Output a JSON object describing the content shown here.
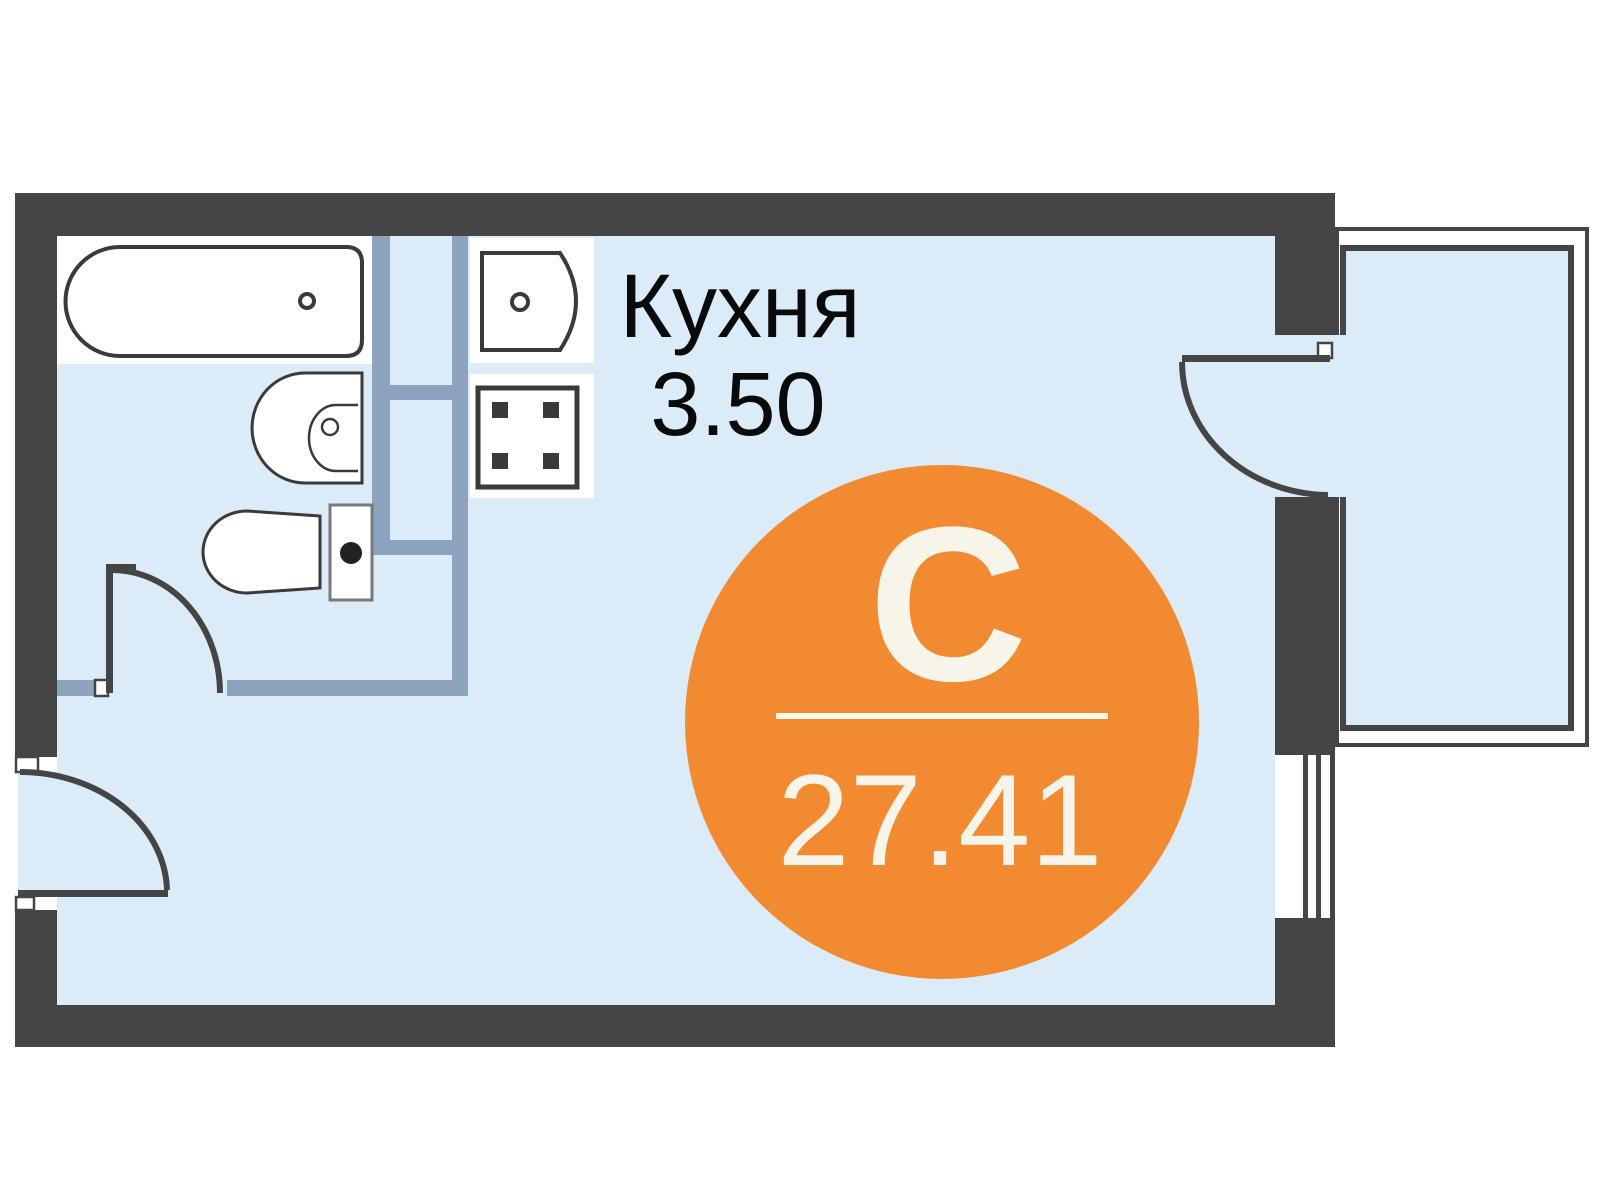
{
  "rooms": {
    "kitchen": {
      "label": "Кухня",
      "area": "3.50"
    }
  },
  "unit_badge": {
    "letter": "С",
    "area": "27.41",
    "color": "#F18A30",
    "text_color": "#F7F4E9"
  },
  "colors": {
    "background": "#FFFFFF",
    "wall": "#454545",
    "partition": "#8CA3BE",
    "floor": "#DCEBF8",
    "fixture_outline": "#3A3A3A",
    "label_text": "#0A0A0A"
  }
}
